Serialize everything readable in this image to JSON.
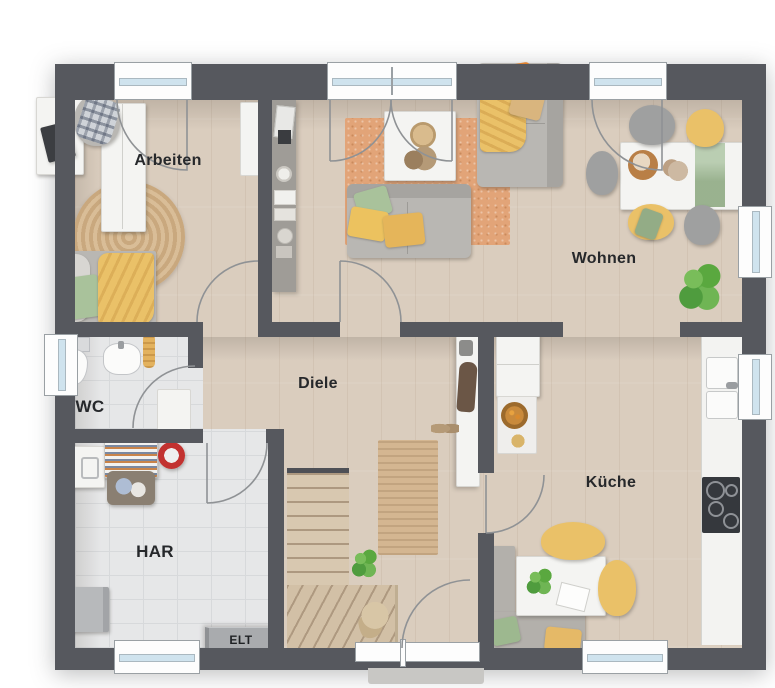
{
  "plan": {
    "type": "floor-plan",
    "floor": "ground-floor"
  },
  "rooms": {
    "arbeiten": {
      "label": "Arbeiten"
    },
    "wohnen": {
      "label": "Wohnen"
    },
    "diele": {
      "label": "Diele"
    },
    "wc": {
      "label": "WC"
    },
    "har": {
      "label": "HAR"
    },
    "kueche": {
      "label": "Küche"
    }
  },
  "annotations": {
    "elt": "ELT"
  },
  "features": {
    "doors": [
      "terrace-door-arbeiten",
      "french-door-wohnen",
      "terrace-door-wohnen-right",
      "door-arbeiten",
      "door-wc",
      "door-har",
      "door-kueche",
      "door-wohnen",
      "entrance-door"
    ],
    "windows": [
      "window-wc-left",
      "window-wohnen-right",
      "window-kueche-right",
      "window-har-bottom",
      "window-kueche-bottom"
    ],
    "stairs": "winder-staircase-to-upper-floor"
  },
  "palette": {
    "wall": "#56585e",
    "floorWood": "#dacdbe",
    "floorTile": "#e6e7e8",
    "rugOrange": "#e2a478",
    "jute": "#d4b691",
    "sofa": "#b9b7b3",
    "accentYellow": "#eac168",
    "accentGreen": "#a9c29b",
    "accentOrange": "#e0822f",
    "stair": "#d8c8b0",
    "counter": "#f3f3f1",
    "cooktop": "#35383d",
    "windowGlass": "#cfe3ee",
    "arc": "#8f9295",
    "text": "#26282b"
  }
}
